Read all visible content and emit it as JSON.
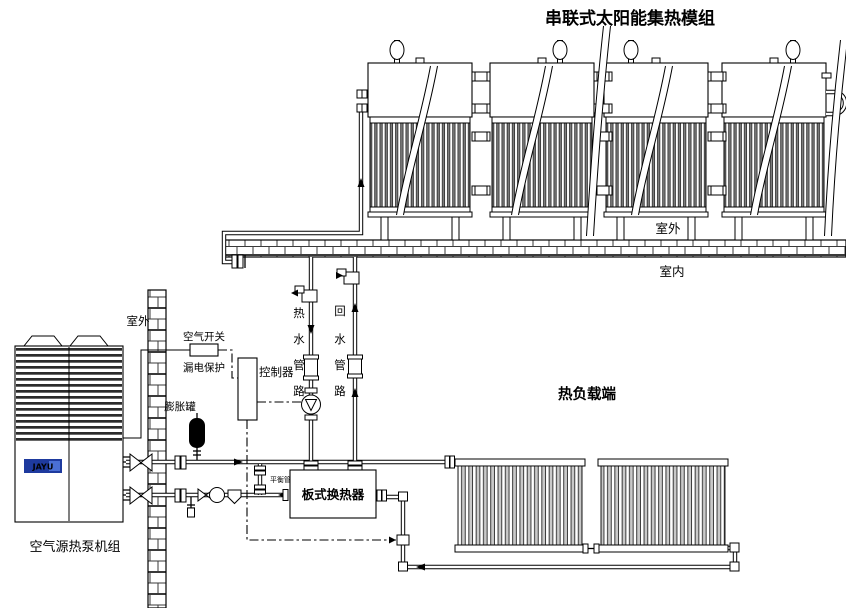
{
  "title": "串联式太阳能集热模组",
  "labels": {
    "roof_outdoor": "室外",
    "roof_indoor": "室内",
    "wall_outdoor": "室外",
    "air_switch": "空气开关",
    "leakage_protection": "漏电保护",
    "controller": "控制器",
    "expansion_tank": "膨胀罐",
    "balance_pipe": "平衡管",
    "plate_heat_exchanger": "板式换热器",
    "heat_load": "热负载端",
    "heat_pump": "空气源热泵机组",
    "heat_pump_logo": "JAYU"
  },
  "pipes": {
    "hot_water": {
      "chars": [
        "热",
        "水",
        "管",
        "路"
      ]
    },
    "return_water": {
      "chars": [
        "回",
        "水",
        "管",
        "路"
      ]
    }
  },
  "colors": {
    "line": "#000000",
    "logo_blue": "#1e3a9e",
    "tube_gray": "#7d7d7d",
    "fin_gray": "#c9c9c9",
    "tank_black": "#000000",
    "background": "#ffffff"
  }
}
